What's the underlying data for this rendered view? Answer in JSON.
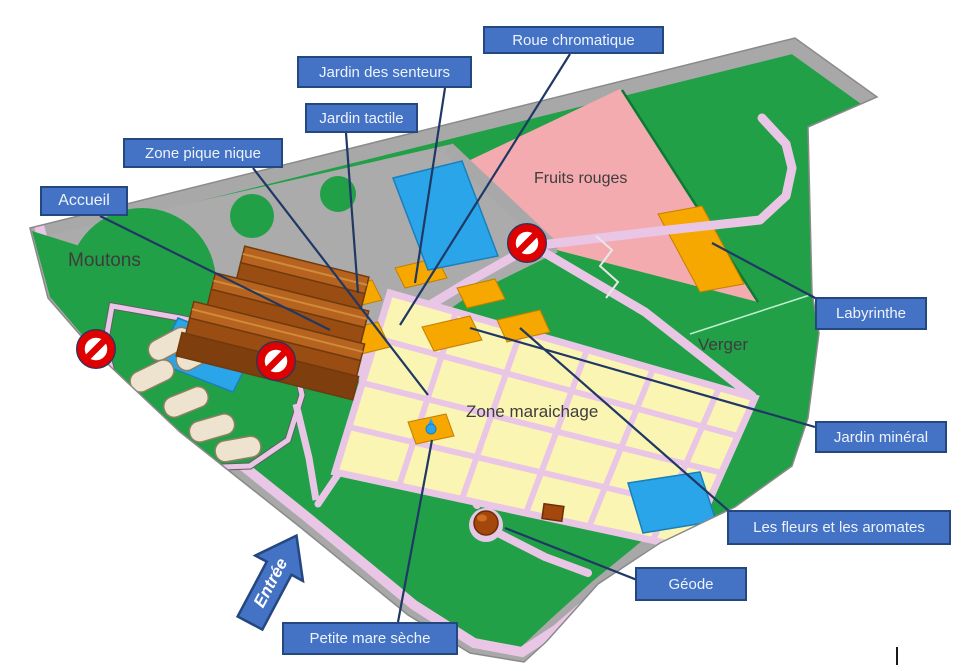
{
  "map_title": "Plan du jardin",
  "colors": {
    "background": "#FFFFFF",
    "label_fill": "#4472C4",
    "label_border": "#24477F",
    "label_text": "#EDF3FB",
    "leader_line": "#1F3864",
    "grass_green": "#21A047",
    "road_gray": "#A8A8A8",
    "path_pink": "#EAC6E6",
    "fruits_rouges_pink": "#F4ABB0",
    "plot_cream": "#FBF5B4",
    "plot_orange": "#F6A700",
    "water_blue": "#2AA5EA",
    "building_brown": "#A85A1A",
    "no_entry_red": "#DF0000"
  },
  "callouts": [
    {
      "id": "roue-chromatique",
      "label": "Roue chromatique"
    },
    {
      "id": "jardin-des-senteurs",
      "label": "Jardin des senteurs"
    },
    {
      "id": "jardin-tactile",
      "label": "Jardin tactile"
    },
    {
      "id": "zone-pique-nique",
      "label": "Zone pique nique"
    },
    {
      "id": "accueil",
      "label": "Accueil"
    },
    {
      "id": "labyrinthe",
      "label": "Labyrinthe"
    },
    {
      "id": "jardin-mineral",
      "label": "Jardin minéral"
    },
    {
      "id": "les-fleurs-et-les-aromates",
      "label": "Les fleurs et les aromates"
    },
    {
      "id": "geode",
      "label": "Géode"
    },
    {
      "id": "petite-mare-seche",
      "label": "Petite mare sèche"
    }
  ],
  "map_texts": [
    {
      "id": "moutons",
      "text": "Moutons"
    },
    {
      "id": "fruits-rouges",
      "text": "Fruits rouges"
    },
    {
      "id": "verger",
      "text": "Verger"
    },
    {
      "id": "zone-maraichage",
      "text": "Zone maraichage"
    }
  ],
  "entrance": {
    "label": "Entrée"
  },
  "icons": {
    "no_entry_signs": 3,
    "entrance_arrow": "arrow pointing up-right",
    "geode_marker": "brown sphere",
    "pond_count": 3
  }
}
